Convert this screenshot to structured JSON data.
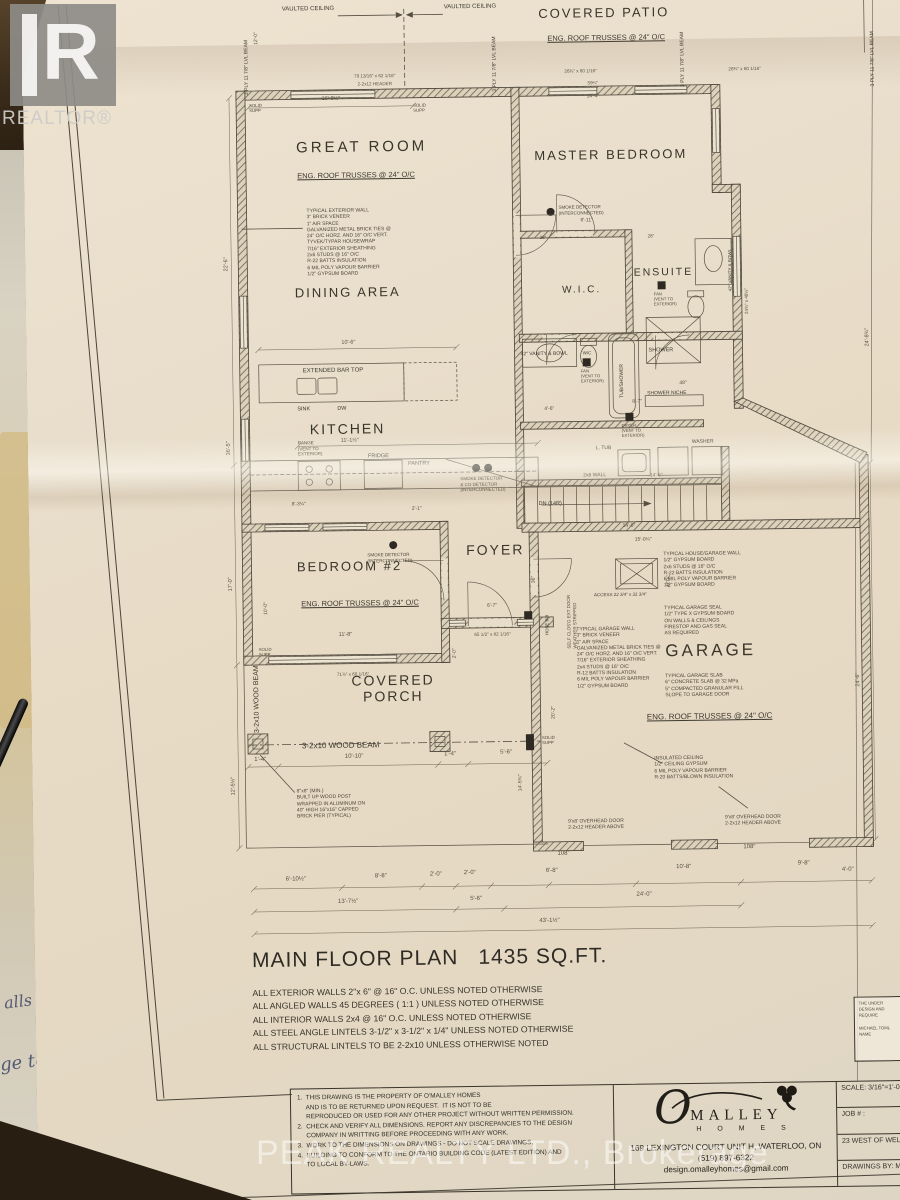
{
  "watermarks": {
    "realtor_logo_letter": "R",
    "realtor": "REALTOR®",
    "peak": "PEAK REALTY LTD., Brokerage"
  },
  "handwriting": {
    "f1": "alls",
    "f2": "ge to"
  },
  "rooms": {
    "patio": "COVERED PATIO",
    "great": "GREAT ROOM",
    "master": "MASTER BEDROOM",
    "dining": "DINING AREA",
    "wic": "W.I.C.",
    "ensuite": "ENSUITE",
    "kitchen": "KITCHEN",
    "foyer": "FOYER",
    "bedroom2": "BEDROOM #2",
    "porch": "COVERED\nPORCH",
    "garage": "GARAGE"
  },
  "truss_note": "ENG. ROOF TRUSSES @ 24\" O/C",
  "notes": {
    "ext_wall": "TYPICAL EXTERIOR WALL\n3\" BRICK VENEER\n1\" AIR SPACE\nGALVANIZED METAL BRICK TIES @\n24\" O/C HORZ. AND 16\" O/C VERT.\nTYVEK/TYPAR HOUSEWRAP\n7/16\" EXTERIOR SHEATHING\n2x6 STUDS @ 16\" O/C\nR-22 BATTS INSULATION\n6 MIL POLY VAPOUR BARRIER\n1/2\" GYPSUM BOARD",
    "house_garage_wall": "TYPICAL HOUSE/GARAGE WALL\n1/2\" GYPSUM BOARD\n2x6 STUDS @ 16\" O/C\nR-22 BATTS INSULATION\n6 MIL POLY VAPOUR BARRIER\n1/2\" GYPSUM BOARD",
    "garage_seal": "TYPICAL GARAGE SEAL\n1/2\" TYPE X GYPSUM BOARD\nON WALLS & CEILINGS\nFIRESTOP AND GAS SEAL\nAS REQUIRED",
    "garage_wall": "TYPICAL GARAGE WALL\n3\" BRICK VENEER\n1\" AIR SPACE\nGALVANIZED METAL BRICK TIES @\n24\" O/C HORZ. AND 16\" O/C VERT.\n7/16\" EXTERIOR SHEATHING\n2x4 STUDS @ 16\" O/C\nR-12 BATTS INSULATION\n6 MIL POLY VAPOUR BARRIER\n1/2\" GYPSUM BOARD",
    "garage_slab": "TYPICAL GARAGE SLAB\n6\" CONCRETE SLAB @ 32 MPa\n5\" COMPACTED GRANULAR FILL\nSLOPE TO GARAGE DOOR",
    "insulated_ceiling": "INSULATED CEILING\n1/2\" CEILING GYPSUM\n6 MIL POLY VAPOUR BARRIER\nR-20 BATTS/BLOWN INSULATION",
    "built_up_post": "8\"x8\" (MIN.)\nBUILT UP WOOD POST\nWRAPPED IN ALUMINUM ON\n40\" HIGH 16\"x16\" CAPPED\nBRICK PIER (TYPICAL)",
    "smoke": "SMOKE DETECTOR\n(INTERCONNECTED)",
    "smoke_co": "SMOKE DETECTOR\n& CO DETECTOR\n(INTERCONNECTED)",
    "fan": "FAN\n(VENT TO\nEXTERIOR)",
    "range": "RANGE\n(VENT TO\nEXTERIOR)",
    "dryer": "DRYER\n(VENT TO\nEXTERIOR)",
    "self_closing": "SELF CLOS'G EXT DOOR\nWEATHER STRIPPED",
    "overhead_door": "9'x8' OVERHEAD DOOR\n2-2x12 HEADER ABOVE",
    "header_2212": "2-2x12 HEADER"
  },
  "labels": {
    "vaulted": "VAULTED CEILING",
    "lvl_beam": "3 PLY 11 7/8\" LVL BEAM",
    "bar_top": "EXTENDED BAR TOP",
    "sink": "SINK",
    "dw": "DW",
    "fridge": "FRIDGE",
    "pantry": "PANTRY",
    "ltub": "L. TUB",
    "washer": "WASHER",
    "vanity": "42\" VANITY & BOWL",
    "wc": "W/C",
    "tub_shower": "TUB/SHOWER",
    "shower": "SHOWER",
    "shower_niche": "SHOWER NICHE",
    "wood_beam": "3-2x10 WOOD BEAM",
    "solid_supp": "SOLID\nSUPP",
    "attic_access": "ACCESS 22 3/4\" x 32 3/4\"",
    "attic": "ATTIC",
    "dn": "DN (14R)",
    "wall26": "2x6 WALL",
    "hose_bib": "HOSE BIB"
  },
  "dims": {
    "b1": "6'-10½\"",
    "b2": "8'-8\"",
    "b3": "2'-0\"",
    "b4": "2'-0\"",
    "b5": "6'-8\"",
    "b6": "10'-8\"",
    "b7": "9'-8\"",
    "in108": "108\"",
    "m1": "13'-7½\"",
    "m2": "5'-6\"",
    "m3": "24'-0\"",
    "total": "43'-1½\"",
    "r40": "4'-0\"",
    "p14": "1'-4\"",
    "p1010": "10'-10\"",
    "p56": "5'-6\"",
    "p145": "14'-5¾\"",
    "p202": "20'-2\"",
    "t1": "79 13/16\" x 62 1/16\"",
    "t2": "16'-8½\"",
    "t3": "26¾\" x 60 1/16\"",
    "t4": "59¼\"",
    "t5": "14'-4\"",
    "t6": "12'-0\"",
    "l1": "22'-6\"",
    "l2": "36'-5\"",
    "l3": "17'-0\"",
    "l4": "12'-5½\"",
    "l5": "10'-0\"",
    "r1": "24¾\" x 48¼\"",
    "r2": "24'-8¾\"",
    "r3": "24'-6\"",
    "i1": "8'-11\"",
    "i2": "28\"",
    "i3": "10'-6\"",
    "i4": "11'-1½\"",
    "i5": "11'-8\"",
    "i6": "71⅞\" x 60 1/16\"",
    "i7": "65 1/2\" x 82 1/16\"",
    "i8": "6'-7\"",
    "i9": "14'-6\"",
    "i10": "15'-0¼\"",
    "i11": "8'-7\"",
    "i12": "4'-6\"",
    "i13": "48\"",
    "i14": "36\"",
    "i15": "2'-0\"",
    "i17": "8'-3¼\"",
    "i18": "2'-1\""
  },
  "title": {
    "name": "MAIN FLOOR PLAN",
    "area": "1435 SQ.FT.",
    "notes": "ALL EXTERIOR WALLS 2\"x 6\" @ 16\" O.C. UNLESS NOTED OTHERWISE\nALL ANGLED WALLS 45 DEGREES ( 1:1 ) UNLESS NOTED OTHERWISE\nALL INTERIOR WALLS 2x4 @ 16\" O.C. UNLESS NOTED OTHERWISE\nALL STEEL ANGLE LINTELS 3-1/2\" x 3-1/2\" x 1/4\" UNLESS NOTED OTHERWISE\nALL STRUCTURAL LINTELS TO BE 2-2x10 UNLESS OTHERWISE NOTED"
  },
  "titleblock": {
    "notes": "1.  THIS DRAWING IS THE PROPERTY OF O'MALLEY HOMES\n     AND IS TO BE RETURNED UPON REQUEST.  IT IS NOT TO BE\n     REPRODUCED OR USED FOR ANY OTHER PROJECT WITHOUT WRITTEN PERMISSION.\n2.  CHECK AND VERIFY ALL DIMENSIONS. REPORT ANY DISCREPANCIES TO THE DESIGN\n     COMPANY IN WRITTING BEFORE PROCEEDING WITH ANY WORK.\n3.  WORK TO THE DIMENSIONS ON DRAWINGS - DO NOT SCALE DRAWINGS.\n4.  BUILDING TO CONFORM TO THE ONTARIO BUILDING CODE (LATEST EDITION) AND\n     TO LOCAL BY-LAWS.",
    "logo_o": "O",
    "logo_name": "MALLEY",
    "logo_sub": "H O M E S",
    "address": "169 LEXINGTON COURT UNIT H, WATERLOO, ON",
    "phone": "(519) 897-6322",
    "email": "design.omalleyhomes@gmail.com",
    "scale": "SCALE: 3/16\"=1'-0\"",
    "job": "JOB # :",
    "project": "23 WEST OF WELLINGTON",
    "drawn": "DRAWINGS BY:  M.T.",
    "stamp": "THE UNDER\nDESIGN AND\nREQUIRE\n\nMICHAEL TOML\nNAME"
  }
}
